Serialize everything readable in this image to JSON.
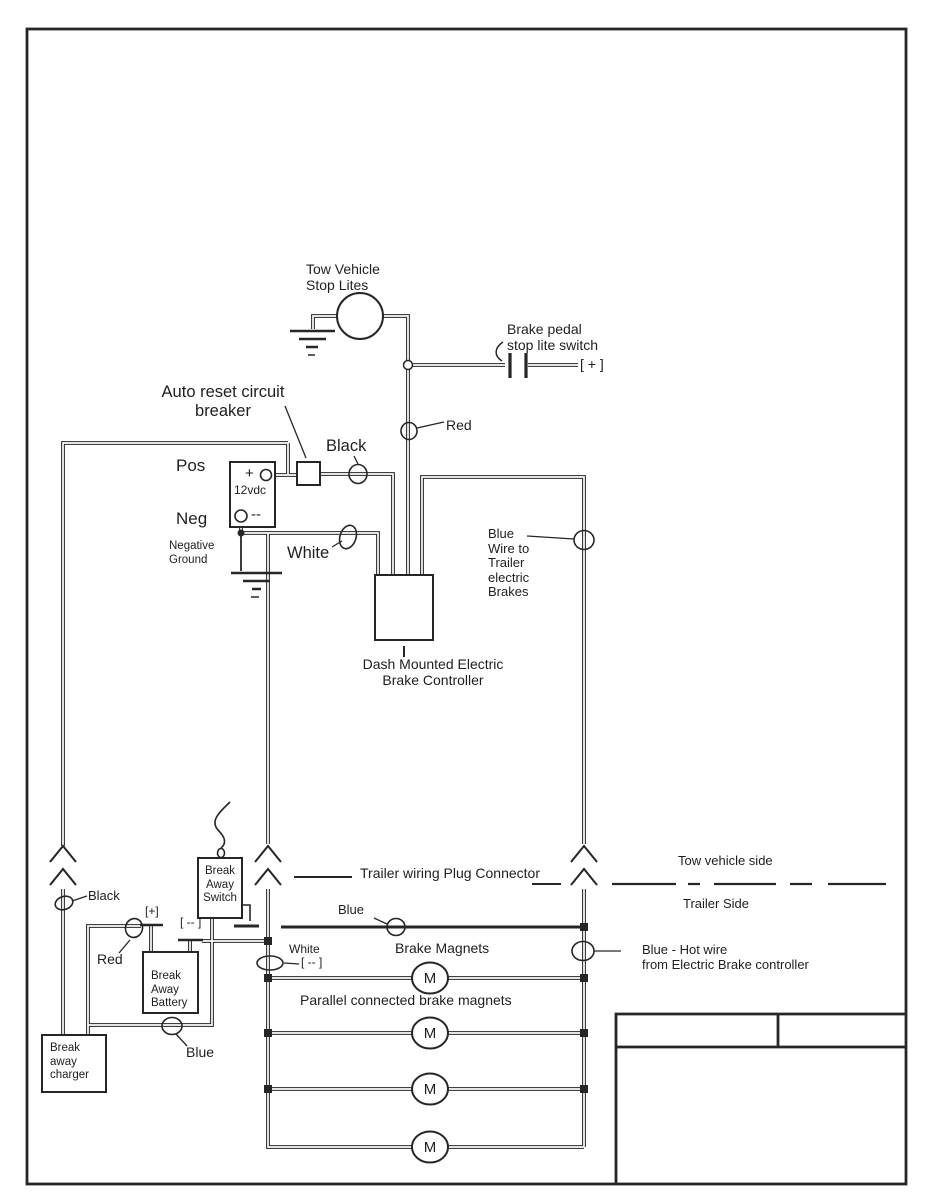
{
  "colors": {
    "ink": "#262626",
    "background": "#ffffff"
  },
  "tow": {
    "stop_lites": "Tow Vehicle\nStop Lites",
    "brake_pedal_switch": "Brake pedal\nstop lite switch",
    "plus_terminal": "[ + ]",
    "auto_reset": "Auto reset circuit\nbreaker",
    "pos": "Pos",
    "neg": "Neg",
    "battery_plus": "+",
    "battery_voltage": "12vdc",
    "battery_minus": "--",
    "negative_ground": "Negative\nGround",
    "wire_black": "Black",
    "wire_red": "Red",
    "wire_white": "White",
    "blue_wire_note": "Blue\nWire to\nTrailer\nelectric\nBrakes",
    "controller": "Dash Mounted Electric\nBrake Controller"
  },
  "boundary": {
    "plug_connector": "Trailer wiring Plug Connector",
    "tow_side": "Tow vehicle side",
    "trailer_side": "Trailer Side"
  },
  "breakaway": {
    "wire_black": "Black",
    "wire_red": "Red",
    "wire_blue": "Blue",
    "plus": "[+]",
    "minus": "[ -- ]",
    "switch_label": "Break\nAway\nSwitch",
    "battery_label": "Break\nAway\nBattery",
    "charger_label": "Break\naway\ncharger"
  },
  "trailer": {
    "wire_blue": "Blue",
    "wire_white": "White",
    "white_minus": "[ -- ]",
    "magnets_heading": "Brake Magnets",
    "parallel_note": "Parallel connected brake magnets",
    "blue_hot_note": "Blue - Hot wire\nfrom Electric Brake controller",
    "magnet_label": "M"
  }
}
